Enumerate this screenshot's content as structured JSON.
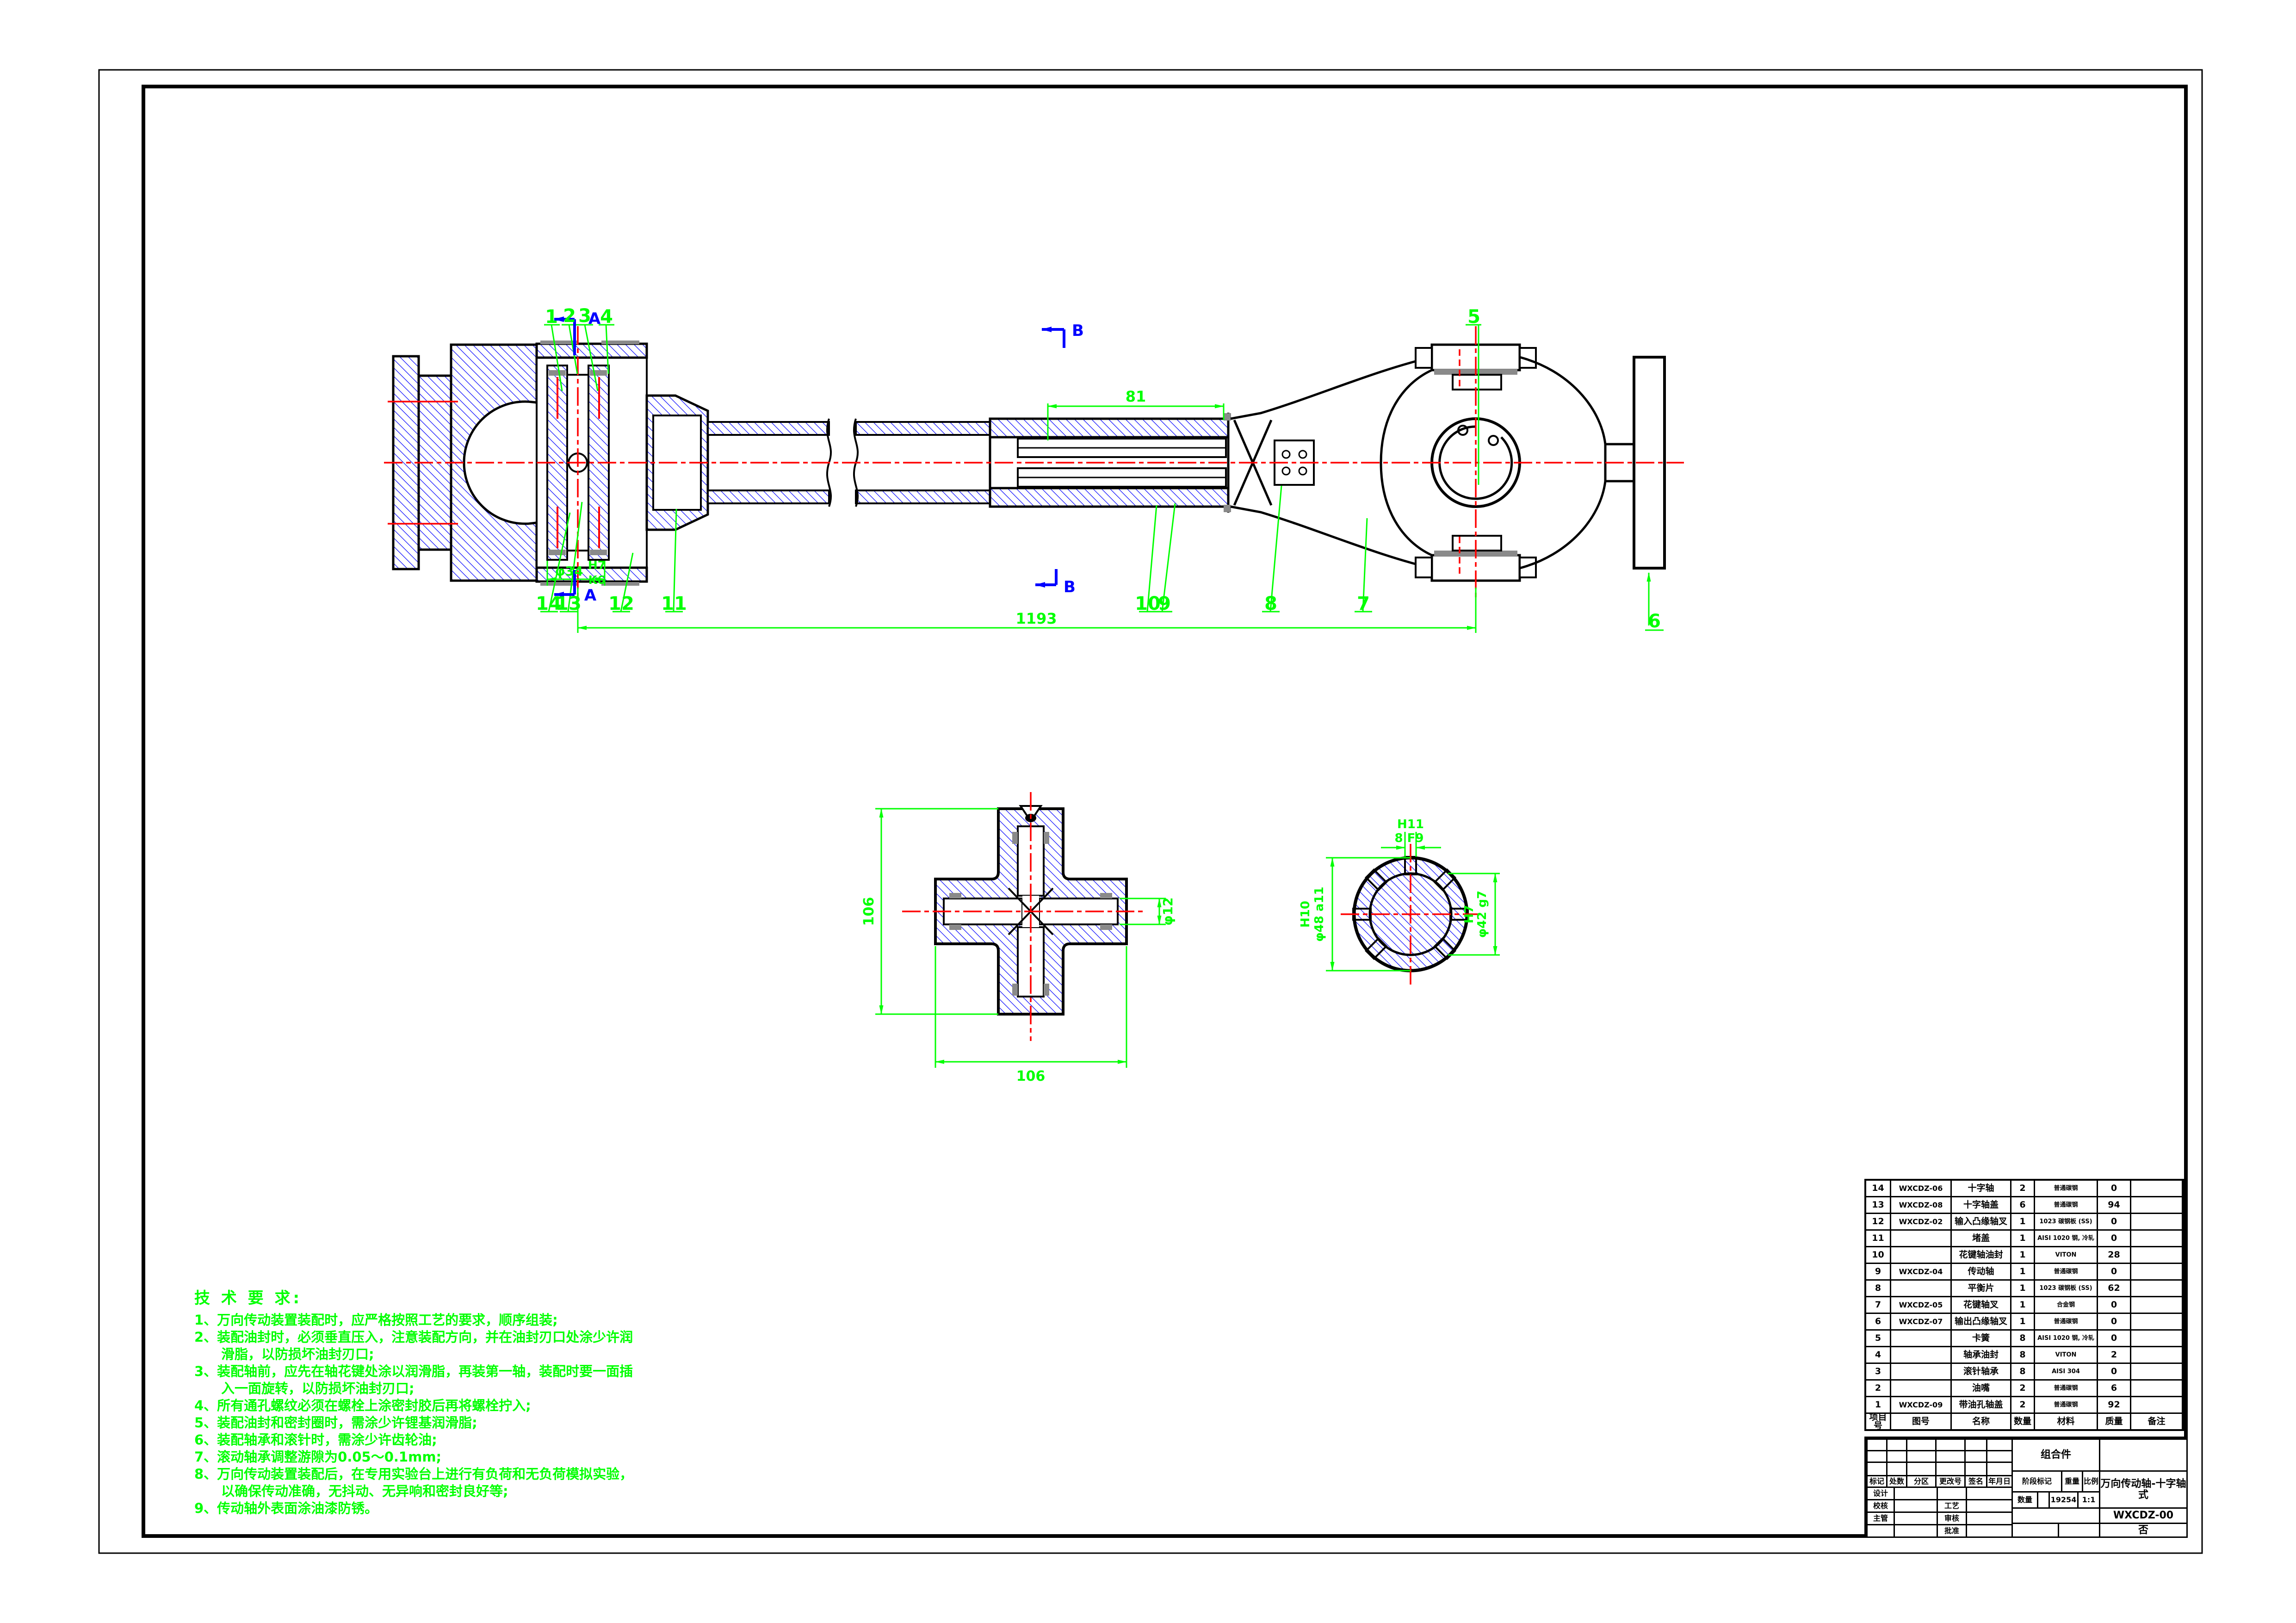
{
  "colors": {
    "outline": "#000000",
    "hatch": "#0000FF",
    "centerline": "#FF0000",
    "dimension": "#00FF00",
    "section_mark": "#0000FF",
    "background": "#FFFFFF"
  },
  "tech": {
    "title": "技 术 要 求:",
    "items": [
      "1、万向传动装置装配时，应严格按照工艺的要求，顺序组装;",
      "2、装配油封时，必须垂直压入，注意装配方向，并在油封刃口处涂少许润滑脂，以防损坏油封刃口;",
      "3、装配轴前，应先在轴花键处涂以润滑脂，再装第一轴，装配时要一面插入一面旋转，以防损坏油封刃口;",
      "4、所有通孔螺纹必须在螺栓上涂密封胶后再将螺栓拧入;",
      "5、装配油封和密封圈时，需涂少许锂基润滑脂;",
      "6、装配轴承和滚针时，需涂少许齿轮油;",
      "7、滚动轴承调整游隙为0.05～0.1mm;",
      "8、万向传动装置装配后，在专用实验台上进行有负荷和无负荷模拟实验，以确保传动准确，无抖动、无异响和密封良好等;",
      "9、传动轴外表面涂油漆防锈。"
    ]
  },
  "annotations": {
    "balloons": [
      "1",
      "2",
      "3",
      "4",
      "5",
      "6",
      "7",
      "8",
      "9",
      "10",
      "11",
      "12",
      "13",
      "14"
    ],
    "sections": {
      "a": "A",
      "b": "B"
    },
    "dims": {
      "spline_len": "81",
      "total_len": "1193",
      "bore": "φ34",
      "bore_fit_top": "H7",
      "bore_fit_bot": "K6",
      "cross_v": "106",
      "cross_h": "106",
      "cross_bore": "φ12",
      "sec_top_fit": "H11",
      "sec_top": "8 F9",
      "sec_left_fit": "H10",
      "sec_left": "φ48 a11",
      "sec_right_fit": "H7",
      "sec_right": "φ42 g7"
    }
  },
  "bom": {
    "headers": [
      "项目号",
      "图号",
      "名称",
      "数量",
      "材料",
      "质量",
      "备注"
    ],
    "rows": [
      {
        "no": "14",
        "code": "WXCDZ-06",
        "name": "十字轴",
        "qty": "2",
        "mat": "普通碳钢",
        "mass": "0",
        "note": ""
      },
      {
        "no": "13",
        "code": "WXCDZ-08",
        "name": "十字轴盖",
        "qty": "6",
        "mat": "普通碳钢",
        "mass": "94",
        "note": ""
      },
      {
        "no": "12",
        "code": "WXCDZ-02",
        "name": "输入凸缘轴叉",
        "qty": "1",
        "mat": "1023 碳钢板 (SS)",
        "mass": "0",
        "note": ""
      },
      {
        "no": "11",
        "code": "",
        "name": "堵盖",
        "qty": "1",
        "mat": "AISI 1020 钢, 冷轧",
        "mass": "0",
        "note": ""
      },
      {
        "no": "10",
        "code": "",
        "name": "花键轴油封",
        "qty": "1",
        "mat": "VITON",
        "mass": "28",
        "note": ""
      },
      {
        "no": "9",
        "code": "WXCDZ-04",
        "name": "传动轴",
        "qty": "1",
        "mat": "普通碳钢",
        "mass": "0",
        "note": ""
      },
      {
        "no": "8",
        "code": "",
        "name": "平衡片",
        "qty": "1",
        "mat": "1023 碳钢板 (SS)",
        "mass": "62",
        "note": ""
      },
      {
        "no": "7",
        "code": "WXCDZ-05",
        "name": "花键轴叉",
        "qty": "1",
        "mat": "合金钢",
        "mass": "0",
        "note": ""
      },
      {
        "no": "6",
        "code": "WXCDZ-07",
        "name": "输出凸缘轴叉",
        "qty": "1",
        "mat": "普通碳钢",
        "mass": "0",
        "note": ""
      },
      {
        "no": "5",
        "code": "",
        "name": "卡簧",
        "qty": "8",
        "mat": "AISI 1020 钢, 冷轧",
        "mass": "0",
        "note": ""
      },
      {
        "no": "4",
        "code": "",
        "name": "轴承油封",
        "qty": "8",
        "mat": "VITON",
        "mass": "2",
        "note": ""
      },
      {
        "no": "3",
        "code": "",
        "name": "滚针轴承",
        "qty": "8",
        "mat": "AISI 304",
        "mass": "0",
        "note": ""
      },
      {
        "no": "2",
        "code": "",
        "name": "油嘴",
        "qty": "2",
        "mat": "普通碳钢",
        "mass": "6",
        "note": ""
      },
      {
        "no": "1",
        "code": "WXCDZ-09",
        "name": "带油孔轴盖",
        "qty": "2",
        "mat": "普通碳钢",
        "mass": "92",
        "note": ""
      }
    ]
  },
  "titleblock": {
    "assembly": "组合件",
    "mark": "标记",
    "count": "处数",
    "zone": "分区",
    "change_no": "更改号",
    "sign": "签名",
    "date": "年月日",
    "design": "设计",
    "check": "校核",
    "manage": "主管",
    "process": "工艺",
    "audit": "审核",
    "approve": "批准",
    "stage_mark": "阶段标记",
    "weight_label": "重量",
    "scale_label": "比例",
    "qty_label": "数量",
    "weight": "19254",
    "scale": "1:1",
    "title": "万向传动轴-十字轴式",
    "drawing_no": "WXCDZ-00",
    "sheet": "否"
  }
}
